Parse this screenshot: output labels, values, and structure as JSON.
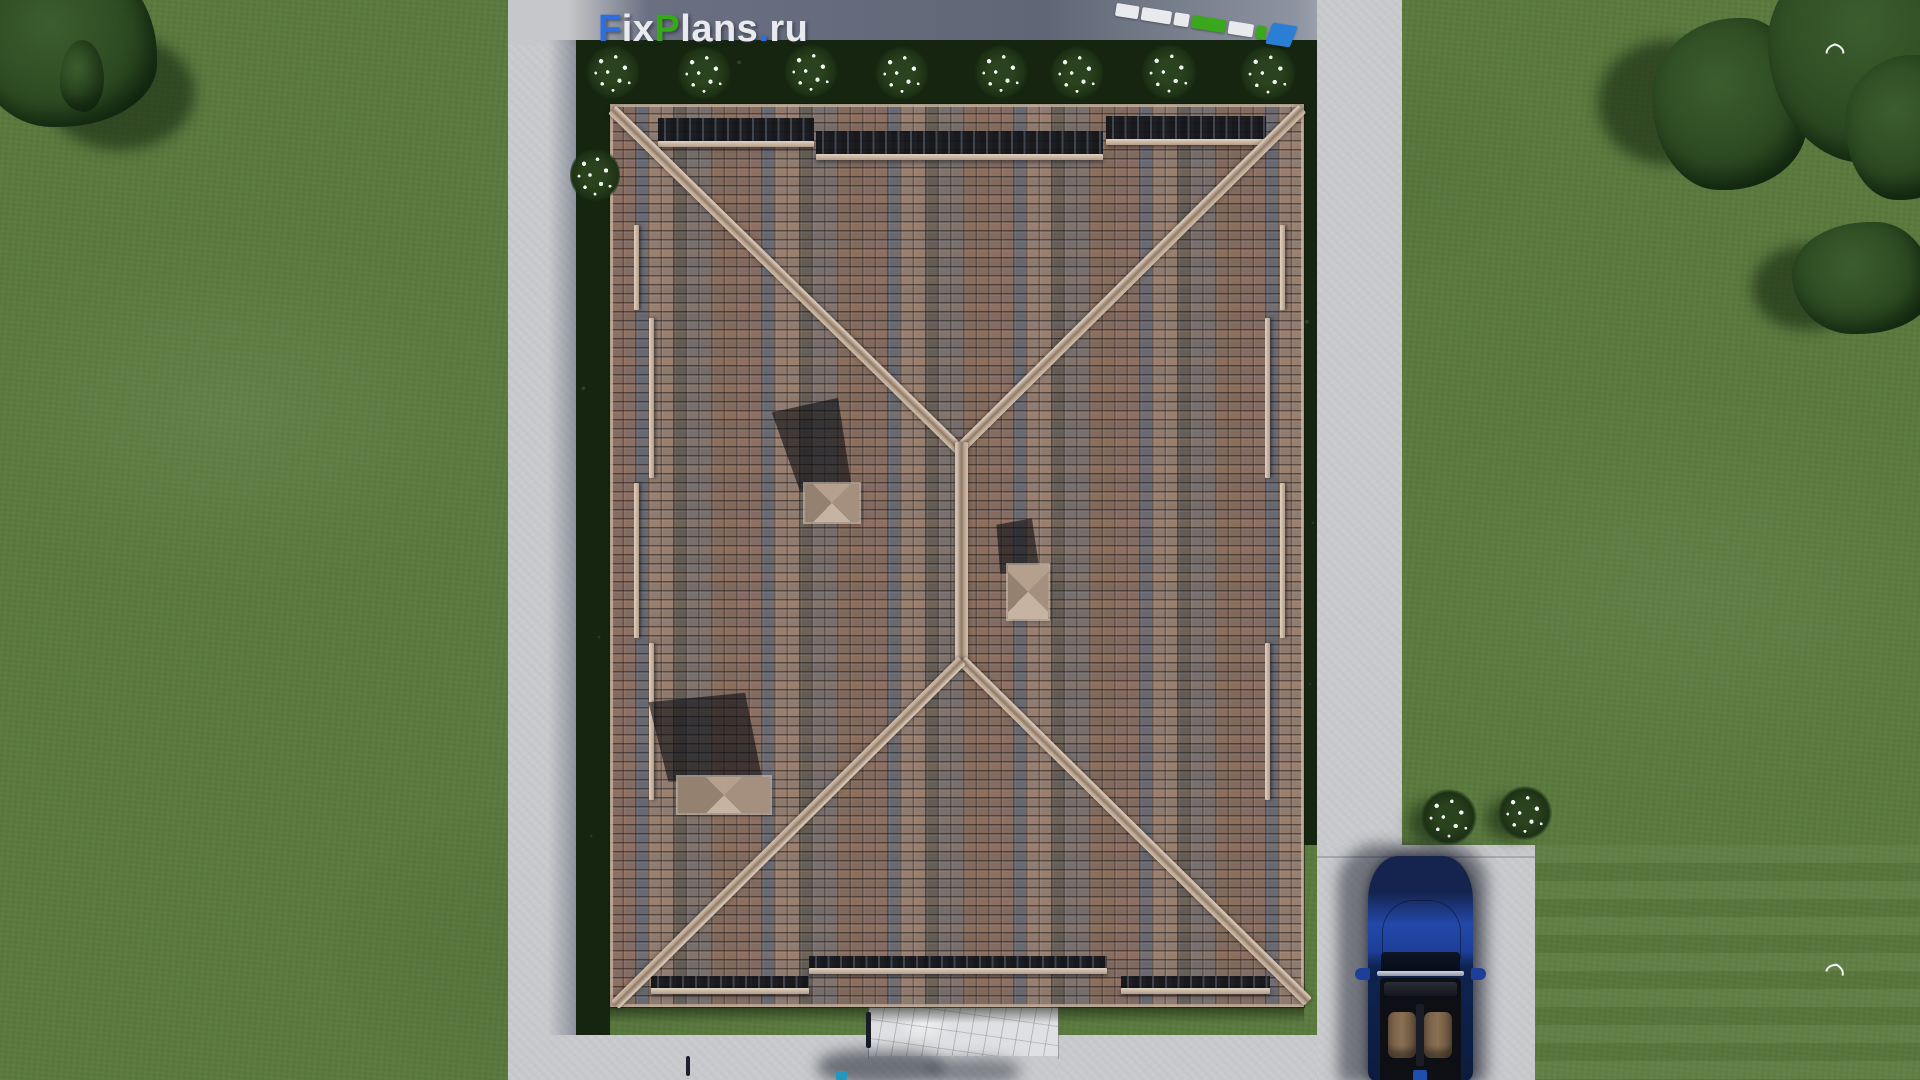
{
  "watermark": {
    "segments": [
      {
        "text": "F",
        "color": "#2e6fe0"
      },
      {
        "text": "ix",
        "color": "#e9eaee"
      },
      {
        "text": "P",
        "color": "#37a918"
      },
      {
        "text": "lans",
        "color": "#e9eaee"
      },
      {
        "text": ".",
        "color": "#2e6fe0"
      },
      {
        "text": "ru",
        "color": "#e9eaee"
      }
    ]
  },
  "colors": {
    "grass": "#5a7a3e",
    "concrete": "#c9cacd",
    "concrete-shaded": "#5f6675",
    "hedge": "#15250f",
    "roof-brown": "#8d7164",
    "roof-gray": "#6d6e76",
    "roof-pink": "#9a8273",
    "eave-shadow": "#14171d",
    "snowbar": "#b29c88",
    "tree": "#2c4a22",
    "walkway": "#dfe0e3",
    "car-blue": "#1d3f9a",
    "car-navy": "#14244f",
    "seat-tan": "#8a7054",
    "ruler-green": "#3aa81c",
    "ruler-blue": "#2a7fd4",
    "ruler-white": "#e8eaee"
  },
  "objects": [
    "lawn",
    "perimeter-path",
    "hedge-strip",
    "flowering-bushes",
    "hip-roof",
    "roof-ridges",
    "snow-guards",
    "chimneys",
    "stone-walkway",
    "driveway",
    "convertible-car",
    "trees",
    "birds",
    "folding-ruler",
    "watermark-logo"
  ]
}
